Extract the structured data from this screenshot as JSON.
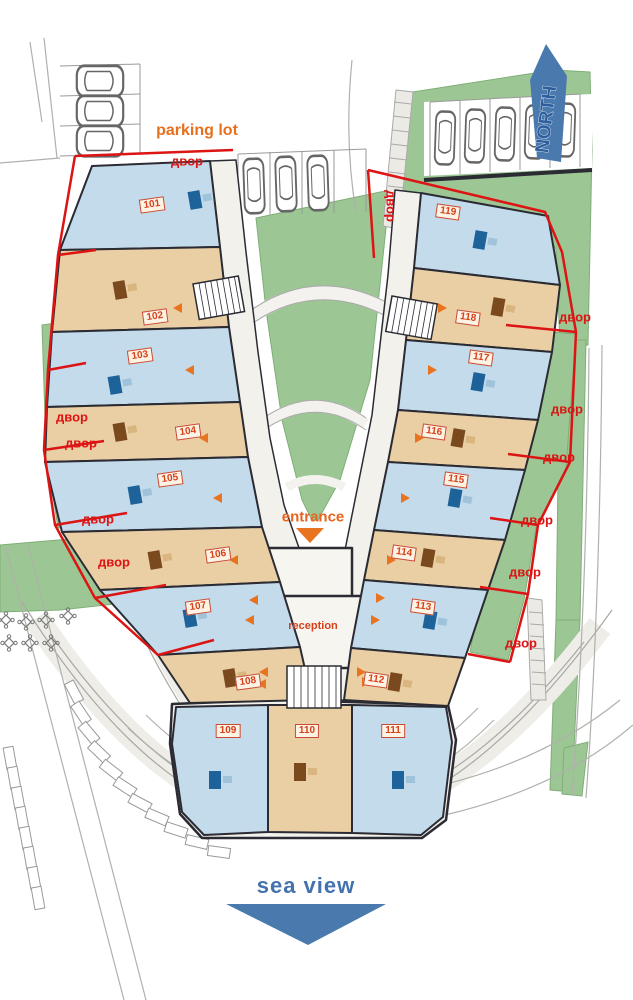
{
  "labels": {
    "parking_lot": "parking lot",
    "north": "NORTH",
    "entrance": "entrance",
    "reception": "reception",
    "sea_view": "sea view",
    "yard": "двор"
  },
  "units": [
    "101",
    "102",
    "103",
    "104",
    "105",
    "106",
    "107",
    "108",
    "109",
    "110",
    "111",
    "112",
    "113",
    "114",
    "115",
    "116",
    "117",
    "118",
    "119"
  ],
  "colors": {
    "boundary_red": "#dc1414",
    "label_orange": "#e8701c",
    "north_blue": "#4a79ad",
    "sea_blue": "#4472ae",
    "lawn_green": "#9cc794",
    "unit_blue": "#c3dbeb",
    "unit_tan": "#eacfa4",
    "wall_dark": "#2b2b33"
  }
}
